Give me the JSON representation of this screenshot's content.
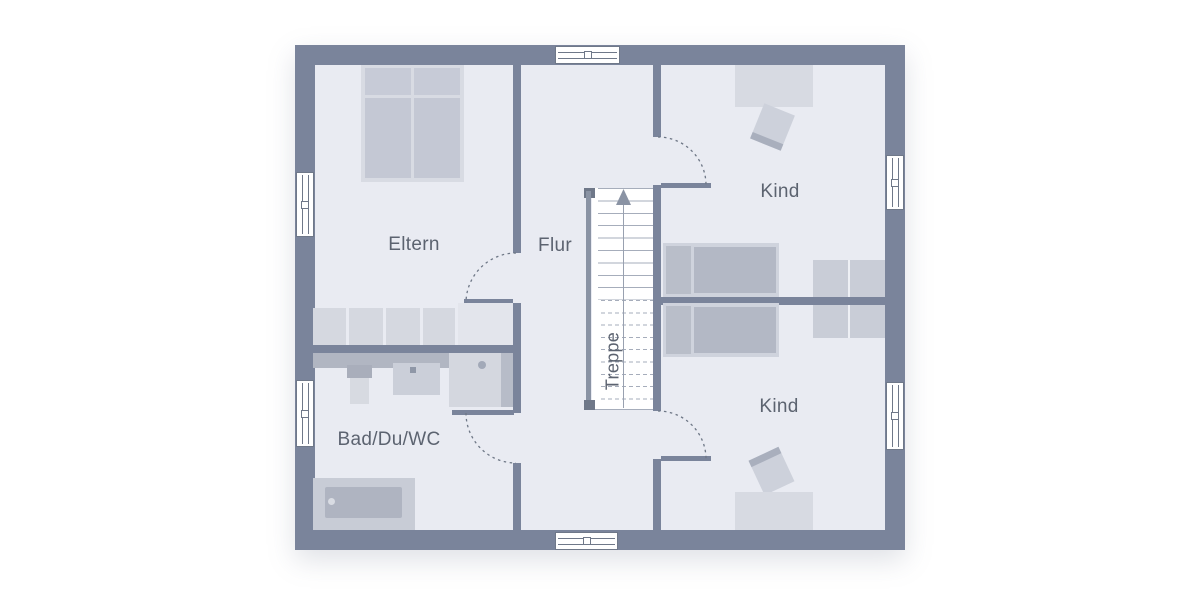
{
  "floorplan": {
    "labels": {
      "eltern": "Eltern",
      "flur": "Flur",
      "kind_top": "Kind",
      "kind_bottom": "Kind",
      "bad": "Bad/Du/WC",
      "treppe": "Treppe"
    },
    "colors": {
      "wall": "#7a849b",
      "floor": "#e9ebf2",
      "window": "#ffffff",
      "frame": "#6f7889",
      "label": "#5c6370",
      "arc": "#6e7786",
      "stairline": "#a6adbb",
      "rail": "#8a93a4",
      "railcap": "#6f7889",
      "furn_light": "#d7dae2",
      "furn_frame": "#d0d4de",
      "furn_mid": "#c6cad6",
      "furn_bed": "#b4b9c6",
      "furn_dark": "#b1b6c2"
    }
  }
}
